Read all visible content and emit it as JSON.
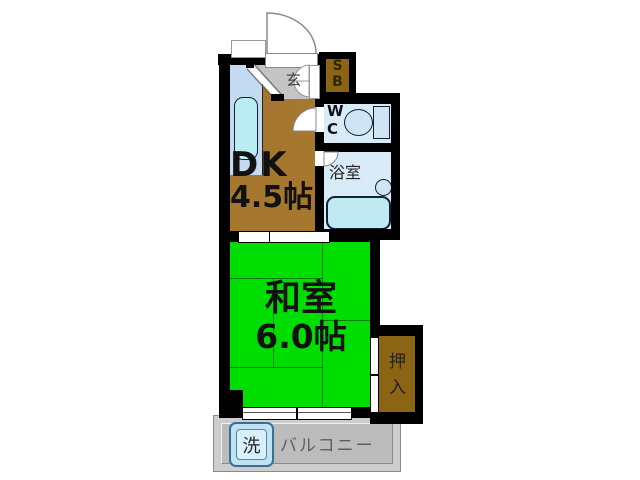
{
  "plan_type": "apartment-floor-plan",
  "rooms": {
    "dk": {
      "name": "DK",
      "size": "4.5帖"
    },
    "washitsu": {
      "name": "和室",
      "size": "6.0帖"
    },
    "genkan": {
      "label": "玄"
    },
    "shoebox": {
      "line1": "S",
      "line2": "B"
    },
    "wc": {
      "line1": "W",
      "line2": "C"
    },
    "bathroom": {
      "label": "浴室"
    },
    "oshiire": {
      "label": "押入"
    },
    "balcony": {
      "label": "バルコニー"
    },
    "washer": {
      "label": "洗"
    }
  },
  "colors": {
    "wall": "#000000",
    "dk_floor": "#a6772e",
    "tatami_green": "#00dd00",
    "closet_brown": "#8b6414",
    "water_room_blue": "#d8ebf8",
    "fixture_cyan": "#bfeaf2",
    "kitchen_counter_blue": "#c3daf0",
    "entrance_tile_gray": "#c4c4c4",
    "balcony_gray": "#bcbcbc"
  }
}
